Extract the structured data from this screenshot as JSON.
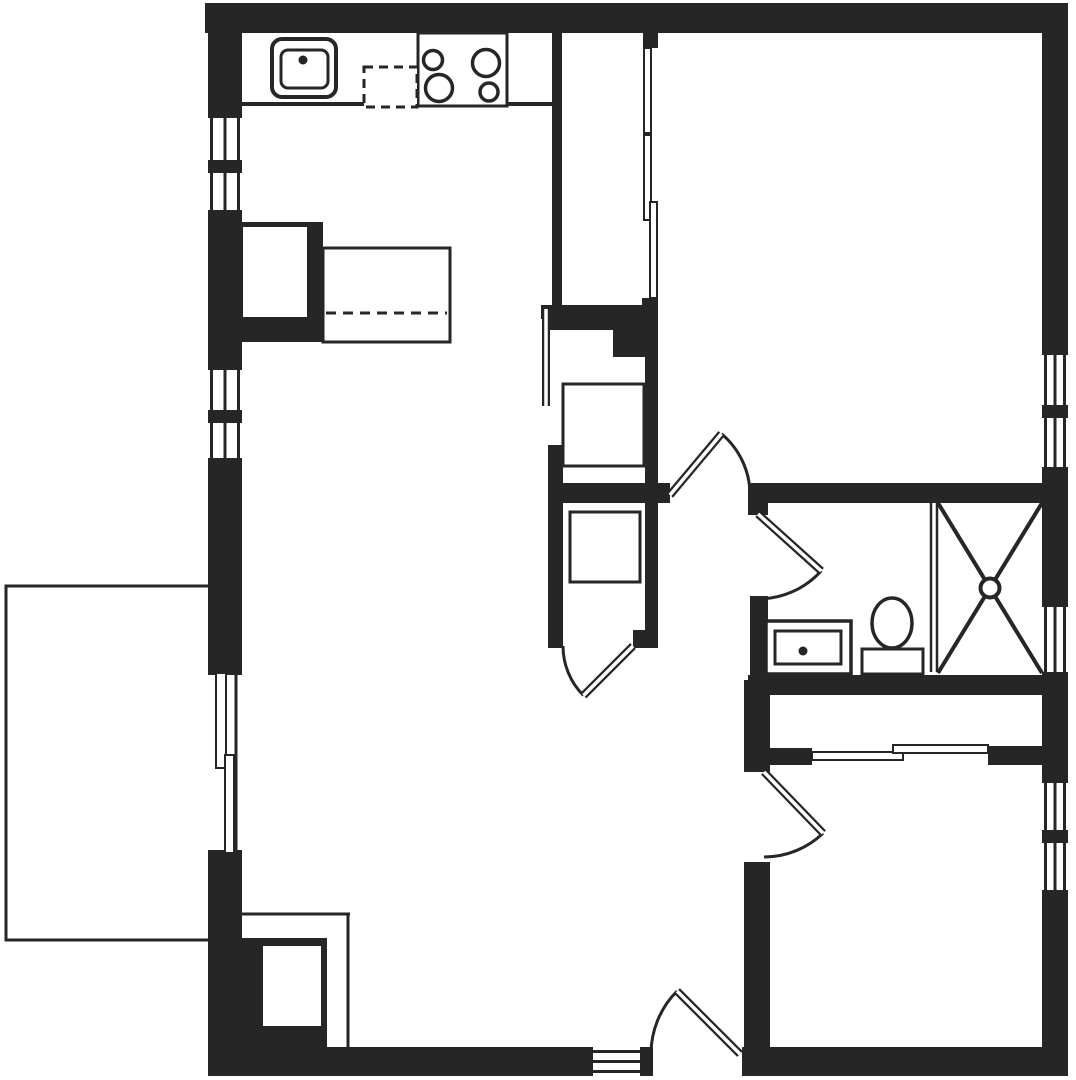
{
  "floorplan": {
    "canvas": {
      "width": 1076,
      "height": 1080
    },
    "colors": {
      "wall": "#262626",
      "line": "#262626",
      "background": "#ffffff"
    },
    "elements": [
      {
        "name": "top-exterior-wall",
        "type": "wall",
        "x": 205,
        "y": 3,
        "w": 863,
        "h": 30
      },
      {
        "name": "left-exterior-wall-upper",
        "type": "wall",
        "x": 208,
        "y": 3,
        "w": 34,
        "h": 115
      },
      {
        "name": "left-wall-window1-mullion",
        "type": "wall",
        "x": 208,
        "y": 160,
        "w": 34,
        "h": 13
      },
      {
        "name": "left-exterior-wall-mid",
        "type": "wall",
        "x": 208,
        "y": 210,
        "w": 34,
        "h": 160
      },
      {
        "name": "left-wall-window2-mullion",
        "type": "wall",
        "x": 208,
        "y": 410,
        "w": 34,
        "h": 13
      },
      {
        "name": "left-exterior-wall-lower",
        "type": "wall",
        "x": 208,
        "y": 458,
        "w": 34,
        "h": 217
      },
      {
        "name": "left-exterior-wall-bottom",
        "type": "wall",
        "x": 208,
        "y": 850,
        "w": 34,
        "h": 226
      },
      {
        "name": "right-exterior-wall-upper",
        "type": "wall",
        "x": 1042,
        "y": 3,
        "w": 26,
        "h": 352
      },
      {
        "name": "right-wall-window1-mullion",
        "type": "wall",
        "x": 1042,
        "y": 405,
        "w": 26,
        "h": 13
      },
      {
        "name": "right-exterior-wall-mid1",
        "type": "wall",
        "x": 1042,
        "y": 467,
        "w": 26,
        "h": 140
      },
      {
        "name": "right-exterior-wall-mid2",
        "type": "wall",
        "x": 1042,
        "y": 672,
        "w": 26,
        "h": 111
      },
      {
        "name": "right-wall-window3-mullion",
        "type": "wall",
        "x": 1042,
        "y": 830,
        "w": 26,
        "h": 13
      },
      {
        "name": "right-exterior-wall-lower",
        "type": "wall",
        "x": 1042,
        "y": 890,
        "w": 26,
        "h": 186
      },
      {
        "name": "bottom-exterior-wall-left",
        "type": "wall",
        "x": 208,
        "y": 1047,
        "w": 385,
        "h": 29
      },
      {
        "name": "bottom-wall-entry-jamb",
        "type": "wall",
        "x": 640,
        "y": 1047,
        "w": 13,
        "h": 29
      },
      {
        "name": "bottom-exterior-wall-right",
        "type": "wall",
        "x": 742,
        "y": 1047,
        "w": 326,
        "h": 29
      },
      {
        "name": "kitchen-closet-west-wall",
        "type": "wall",
        "x": 552,
        "y": 33,
        "w": 10,
        "h": 272
      },
      {
        "name": "closet1-door-stub-top",
        "type": "wall",
        "x": 643,
        "y": 33,
        "w": 15,
        "h": 15
      },
      {
        "name": "closet1-door-stub-bottom",
        "type": "wall",
        "x": 642,
        "y": 298,
        "w": 16,
        "h": 14
      },
      {
        "name": "closet-divider-wall",
        "type": "wall",
        "x": 548,
        "y": 305,
        "w": 109,
        "h": 25
      },
      {
        "name": "closet-divider-block",
        "type": "wall",
        "x": 613,
        "y": 330,
        "w": 44,
        "h": 27
      },
      {
        "name": "bedroom1-west-wall",
        "type": "wall",
        "x": 645,
        "y": 312,
        "w": 13,
        "h": 336
      },
      {
        "name": "utility-closet-west-wall",
        "type": "wall",
        "x": 548,
        "y": 445,
        "w": 15,
        "h": 203
      },
      {
        "name": "utility-door-cap",
        "type": "wall",
        "x": 541,
        "y": 305,
        "w": 11,
        "h": 14
      },
      {
        "name": "hall-north-wall",
        "type": "wall",
        "x": 548,
        "y": 483,
        "w": 122,
        "h": 20
      },
      {
        "name": "closet3-door-stub",
        "type": "wall",
        "x": 633,
        "y": 630,
        "w": 25,
        "h": 18
      },
      {
        "name": "bathroom-north-wall",
        "type": "wall",
        "x": 748,
        "y": 483,
        "w": 294,
        "h": 20
      },
      {
        "name": "bathroom-door-stub",
        "type": "wall",
        "x": 748,
        "y": 503,
        "w": 20,
        "h": 12
      },
      {
        "name": "bathroom-west-wall",
        "type": "wall",
        "x": 750,
        "y": 596,
        "w": 18,
        "h": 81
      },
      {
        "name": "bathroom-south-wall",
        "type": "wall",
        "x": 748,
        "y": 675,
        "w": 294,
        "h": 20
      },
      {
        "name": "bedroom2-west-wall-upper",
        "type": "wall",
        "x": 744,
        "y": 680,
        "w": 26,
        "h": 92
      },
      {
        "name": "bedroom2-west-wall-lower",
        "type": "wall",
        "x": 744,
        "y": 862,
        "w": 26,
        "h": 185
      },
      {
        "name": "bedroom2-closet-stub-left",
        "type": "wall",
        "x": 770,
        "y": 748,
        "w": 42,
        "h": 17
      },
      {
        "name": "bedroom2-closet-stub-right",
        "type": "wall",
        "x": 988,
        "y": 746,
        "w": 54,
        "h": 19
      },
      {
        "name": "kitchen-counter-edge",
        "type": "wall",
        "x": 240,
        "y": 102,
        "w": 312,
        "h": 4
      },
      {
        "name": "kitchen-island-cabinet",
        "type": "wall",
        "x": 238,
        "y": 222,
        "w": 85,
        "h": 120
      },
      {
        "name": "kitchen-island-cabinet-inset",
        "type": "white",
        "x": 243,
        "y": 227,
        "w": 64,
        "h": 90
      },
      {
        "name": "entry-closet-fixture",
        "type": "wall",
        "x": 240,
        "y": 938,
        "w": 87,
        "h": 110
      },
      {
        "name": "entry-closet-fixture-inset",
        "type": "white",
        "x": 263,
        "y": 946,
        "w": 58,
        "h": 80
      },
      {
        "name": "balcony-outline",
        "type": "box",
        "x": 6,
        "y": 586,
        "w": 230,
        "h": 354,
        "s": 3,
        "nofill": true
      },
      {
        "name": "entry-closet-partition-h",
        "type": "line",
        "x1": 237,
        "y1": 914,
        "x2": 350,
        "y2": 914,
        "wd": 3
      },
      {
        "name": "entry-closet-partition-v",
        "type": "line",
        "x1": 348,
        "y1": 913,
        "x2": 348,
        "y2": 1047,
        "wd": 3
      },
      {
        "name": "left-wall-window1-pane1",
        "type": "window",
        "x": 208,
        "y": 118,
        "w": 34,
        "h": 42,
        "dir": "v"
      },
      {
        "name": "left-wall-window1-pane2",
        "type": "window",
        "x": 208,
        "y": 173,
        "w": 34,
        "h": 37,
        "dir": "v"
      },
      {
        "name": "left-wall-window2-pane1",
        "type": "window",
        "x": 208,
        "y": 370,
        "w": 34,
        "h": 40,
        "dir": "v"
      },
      {
        "name": "left-wall-window2-pane2",
        "type": "window",
        "x": 208,
        "y": 423,
        "w": 34,
        "h": 35,
        "dir": "v"
      },
      {
        "name": "bedroom1-window-pane1",
        "type": "window",
        "x": 1042,
        "y": 355,
        "w": 26,
        "h": 50,
        "dir": "v"
      },
      {
        "name": "bedroom1-window-pane2",
        "type": "window",
        "x": 1042,
        "y": 418,
        "w": 26,
        "h": 49,
        "dir": "v"
      },
      {
        "name": "bathroom-window",
        "type": "window",
        "x": 1042,
        "y": 607,
        "w": 26,
        "h": 65,
        "dir": "v"
      },
      {
        "name": "bedroom2-window-pane1",
        "type": "window",
        "x": 1042,
        "y": 783,
        "w": 26,
        "h": 47,
        "dir": "v"
      },
      {
        "name": "bedroom2-window-pane2",
        "type": "window",
        "x": 1042,
        "y": 843,
        "w": 26,
        "h": 47,
        "dir": "v"
      },
      {
        "name": "entry-sidelight-window",
        "type": "window",
        "x": 593,
        "y": 1047,
        "w": 47,
        "h": 29,
        "dir": "h"
      },
      {
        "name": "kitchen-sink-outer",
        "type": "box",
        "x": 272,
        "y": 39,
        "w": 64,
        "h": 58,
        "s": 4,
        "rx": 10
      },
      {
        "name": "kitchen-sink-basin",
        "type": "box",
        "x": 281,
        "y": 50,
        "w": 47,
        "h": 38,
        "s": 3,
        "rx": 7
      },
      {
        "name": "kitchen-stove",
        "type": "box",
        "x": 418,
        "y": 33,
        "w": 89,
        "h": 73,
        "s": 3
      },
      {
        "name": "kitchen-dishwasher",
        "type": "box",
        "x": 364,
        "y": 67,
        "w": 53,
        "h": 40,
        "s": 3,
        "dash": true
      },
      {
        "name": "kitchen-island-counter",
        "type": "box",
        "x": 323,
        "y": 248,
        "w": 127,
        "h": 94,
        "s": 3
      },
      {
        "name": "island-overhang-dashed-line",
        "type": "line",
        "x1": 326,
        "y1": 313,
        "x2": 447,
        "y2": 313,
        "wd": 3,
        "dash": true
      },
      {
        "name": "utility-closet-appliance",
        "type": "box",
        "x": 563,
        "y": 384,
        "w": 81,
        "h": 82,
        "s": 3
      },
      {
        "name": "hall-closet-appliance",
        "type": "box",
        "x": 570,
        "y": 512,
        "w": 70,
        "h": 70,
        "s": 3
      },
      {
        "name": "bathroom-vanity",
        "type": "box",
        "x": 766,
        "y": 621,
        "w": 85,
        "h": 53,
        "s": 3.5
      },
      {
        "name": "bathroom-vanity-sink",
        "type": "box",
        "x": 775,
        "y": 631,
        "w": 66,
        "h": 33,
        "s": 3
      },
      {
        "name": "toilet-tank",
        "type": "box",
        "x": 862,
        "y": 649,
        "w": 61,
        "h": 25,
        "s": 3
      },
      {
        "name": "toilet-bowl",
        "type": "ellipse",
        "cx": 892,
        "cy": 623,
        "rx": 20,
        "ry": 25,
        "s": 3.5
      },
      {
        "name": "shower-partition-line1",
        "type": "line",
        "x1": 931,
        "y1": 503,
        "x2": 931,
        "y2": 672,
        "wd": 2.5
      },
      {
        "name": "shower-partition-line2",
        "type": "line",
        "x1": 937,
        "y1": 503,
        "x2": 937,
        "y2": 672,
        "wd": 2.5
      },
      {
        "name": "shower-cross-line1",
        "type": "line",
        "x1": 938,
        "y1": 503,
        "x2": 1042,
        "y2": 673,
        "wd": 4
      },
      {
        "name": "shower-cross-line2",
        "type": "line",
        "x1": 1042,
        "y1": 503,
        "x2": 938,
        "y2": 673,
        "wd": 4
      },
      {
        "name": "shower-drain",
        "type": "circle",
        "cx": 990,
        "cy": 588,
        "r": 9.5,
        "s": 4
      },
      {
        "name": "stove-burner-small-left",
        "type": "circle",
        "cx": 433,
        "cy": 60,
        "r": 9.5,
        "s": 3.5
      },
      {
        "name": "stove-burner-large-left",
        "type": "circle",
        "cx": 439,
        "cy": 88,
        "r": 13.5,
        "s": 3.5
      },
      {
        "name": "stove-burner-large-right",
        "type": "circle",
        "cx": 486,
        "cy": 63,
        "r": 13.5,
        "s": 3.5
      },
      {
        "name": "stove-burner-small-right",
        "type": "circle",
        "cx": 489,
        "cy": 92,
        "r": 9,
        "s": 3.5
      },
      {
        "name": "kitchen-sink-faucet-dot",
        "type": "circle",
        "cx": 303,
        "cy": 60,
        "r": 4.5,
        "fill": "dark"
      },
      {
        "name": "vanity-faucet-dot",
        "type": "circle",
        "cx": 803,
        "cy": 651,
        "r": 4.5,
        "fill": "dark"
      },
      {
        "name": "balcony-slider-panel-a",
        "type": "panel",
        "x": 216,
        "y": 673,
        "w": 10,
        "h": 95
      },
      {
        "name": "balcony-slider-panel-b",
        "type": "panel",
        "x": 225,
        "y": 755,
        "w": 9,
        "h": 98
      },
      {
        "name": "bedroom1-closet-slider-a",
        "type": "panel",
        "x": 644,
        "y": 48,
        "w": 7,
        "h": 85
      },
      {
        "name": "bedroom1-closet-slider-b",
        "type": "panel",
        "x": 644,
        "y": 135,
        "w": 7,
        "h": 85
      },
      {
        "name": "bedroom1-closet-slider-c",
        "type": "panel",
        "x": 650,
        "y": 202,
        "w": 7,
        "h": 96
      },
      {
        "name": "bedroom2-closet-slider-a",
        "type": "panel",
        "x": 812,
        "y": 752,
        "w": 91,
        "h": 8
      },
      {
        "name": "bedroom2-closet-slider-b",
        "type": "panel",
        "x": 893,
        "y": 745,
        "w": 95,
        "h": 8
      },
      {
        "name": "hall-bedroom1-door",
        "type": "door",
        "hinge": [
          670,
          495
        ],
        "r": 80,
        "a1": 0,
        "a2": -50
      },
      {
        "name": "bathroom-door",
        "type": "door",
        "hinge": [
          758,
          514
        ],
        "r": 85,
        "a1": 90,
        "a2": 42
      },
      {
        "name": "bedroom2-door",
        "type": "door",
        "hinge": [
          764,
          772
        ],
        "r": 85,
        "a1": 90,
        "a2": 46
      },
      {
        "name": "entry-door",
        "type": "door",
        "hinge": [
          740,
          1054
        ],
        "r": 89,
        "a1": 180,
        "a2": 225
      },
      {
        "name": "hall-closet-door",
        "type": "door",
        "hinge": [
          633,
          646
        ],
        "r": 70,
        "a1": 180,
        "a2": 135
      },
      {
        "name": "utility-closet-door-leaf",
        "type": "door",
        "hinge": [
          546,
          309
        ],
        "r": 97,
        "a1": null,
        "a2": 90
      }
    ]
  }
}
